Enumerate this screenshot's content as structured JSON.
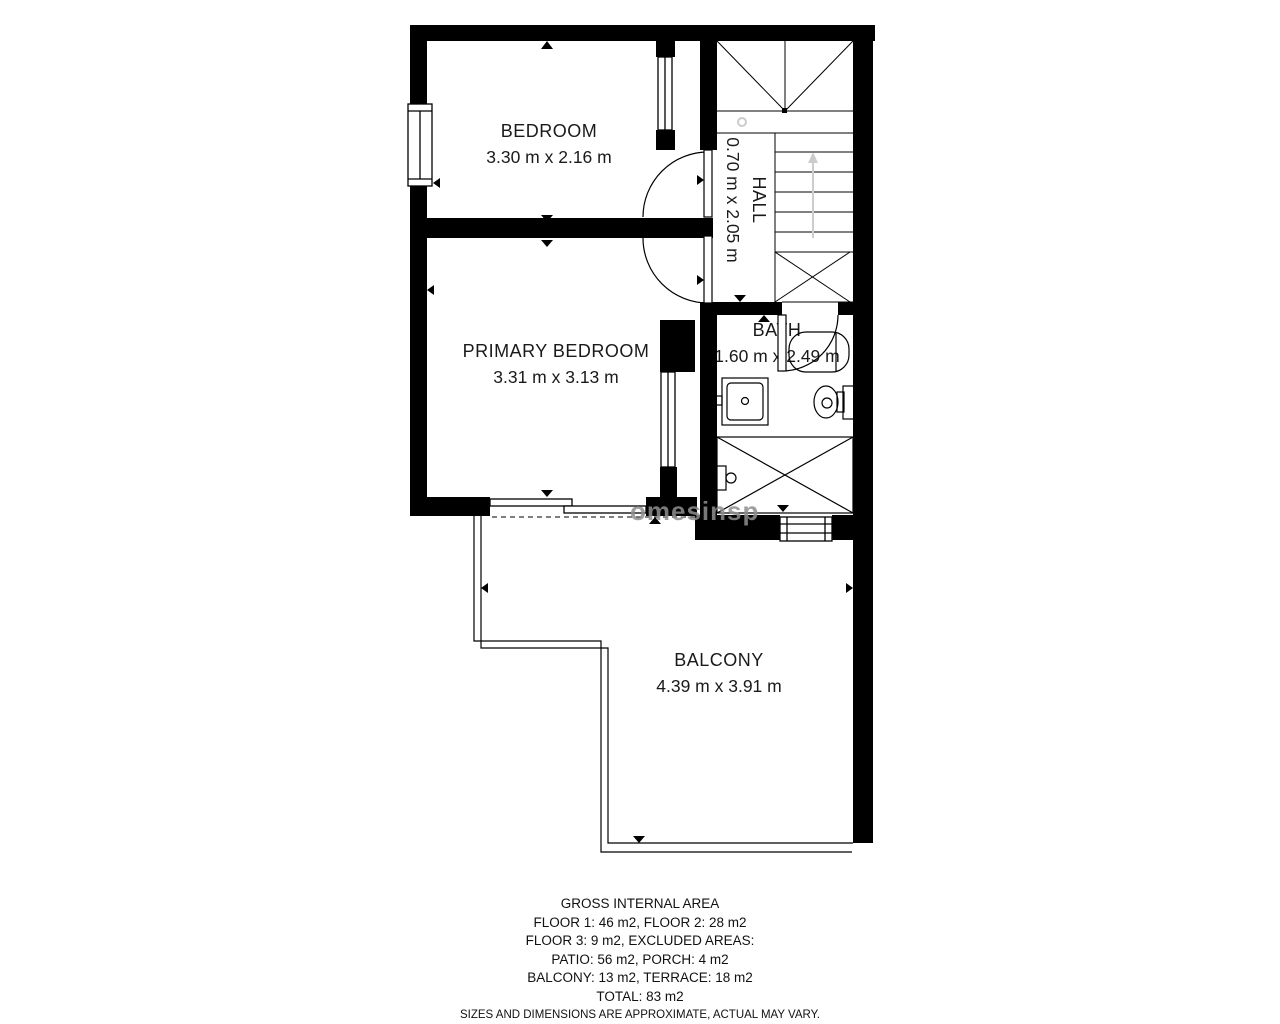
{
  "plan": {
    "watermark": "omesinsp",
    "rooms": [
      {
        "name": "BEDROOM",
        "dims": "3.30 m x 2.16 m"
      },
      {
        "name": "PRIMARY BEDROOM",
        "dims": "3.31 m x 3.13 m"
      },
      {
        "name": "HALL",
        "dims": "0.70 m x 2.05 m"
      },
      {
        "name": "BATH",
        "dims": "1.60 m x 2.49 m"
      },
      {
        "name": "BALCONY",
        "dims": "4.39 m x 3.91 m"
      }
    ]
  },
  "footer": {
    "title": "GROSS INTERNAL AREA",
    "lines": [
      "FLOOR 1: 46 m2, FLOOR 2: 28 m2",
      "FLOOR 3: 9 m2, EXCLUDED AREAS:",
      "PATIO: 56 m2, PORCH: 4 m2",
      "BALCONY: 13 m2, TERRACE: 18 m2",
      "TOTAL: 83 m2"
    ],
    "disclaimer": "SIZES AND DIMENSIONS ARE APPROXIMATE, ACTUAL MAY VARY."
  },
  "colors": {
    "wall": "#000000",
    "line": "#000000",
    "stair_arrow": "#cccccc",
    "watermark": "#8f8f8f"
  }
}
